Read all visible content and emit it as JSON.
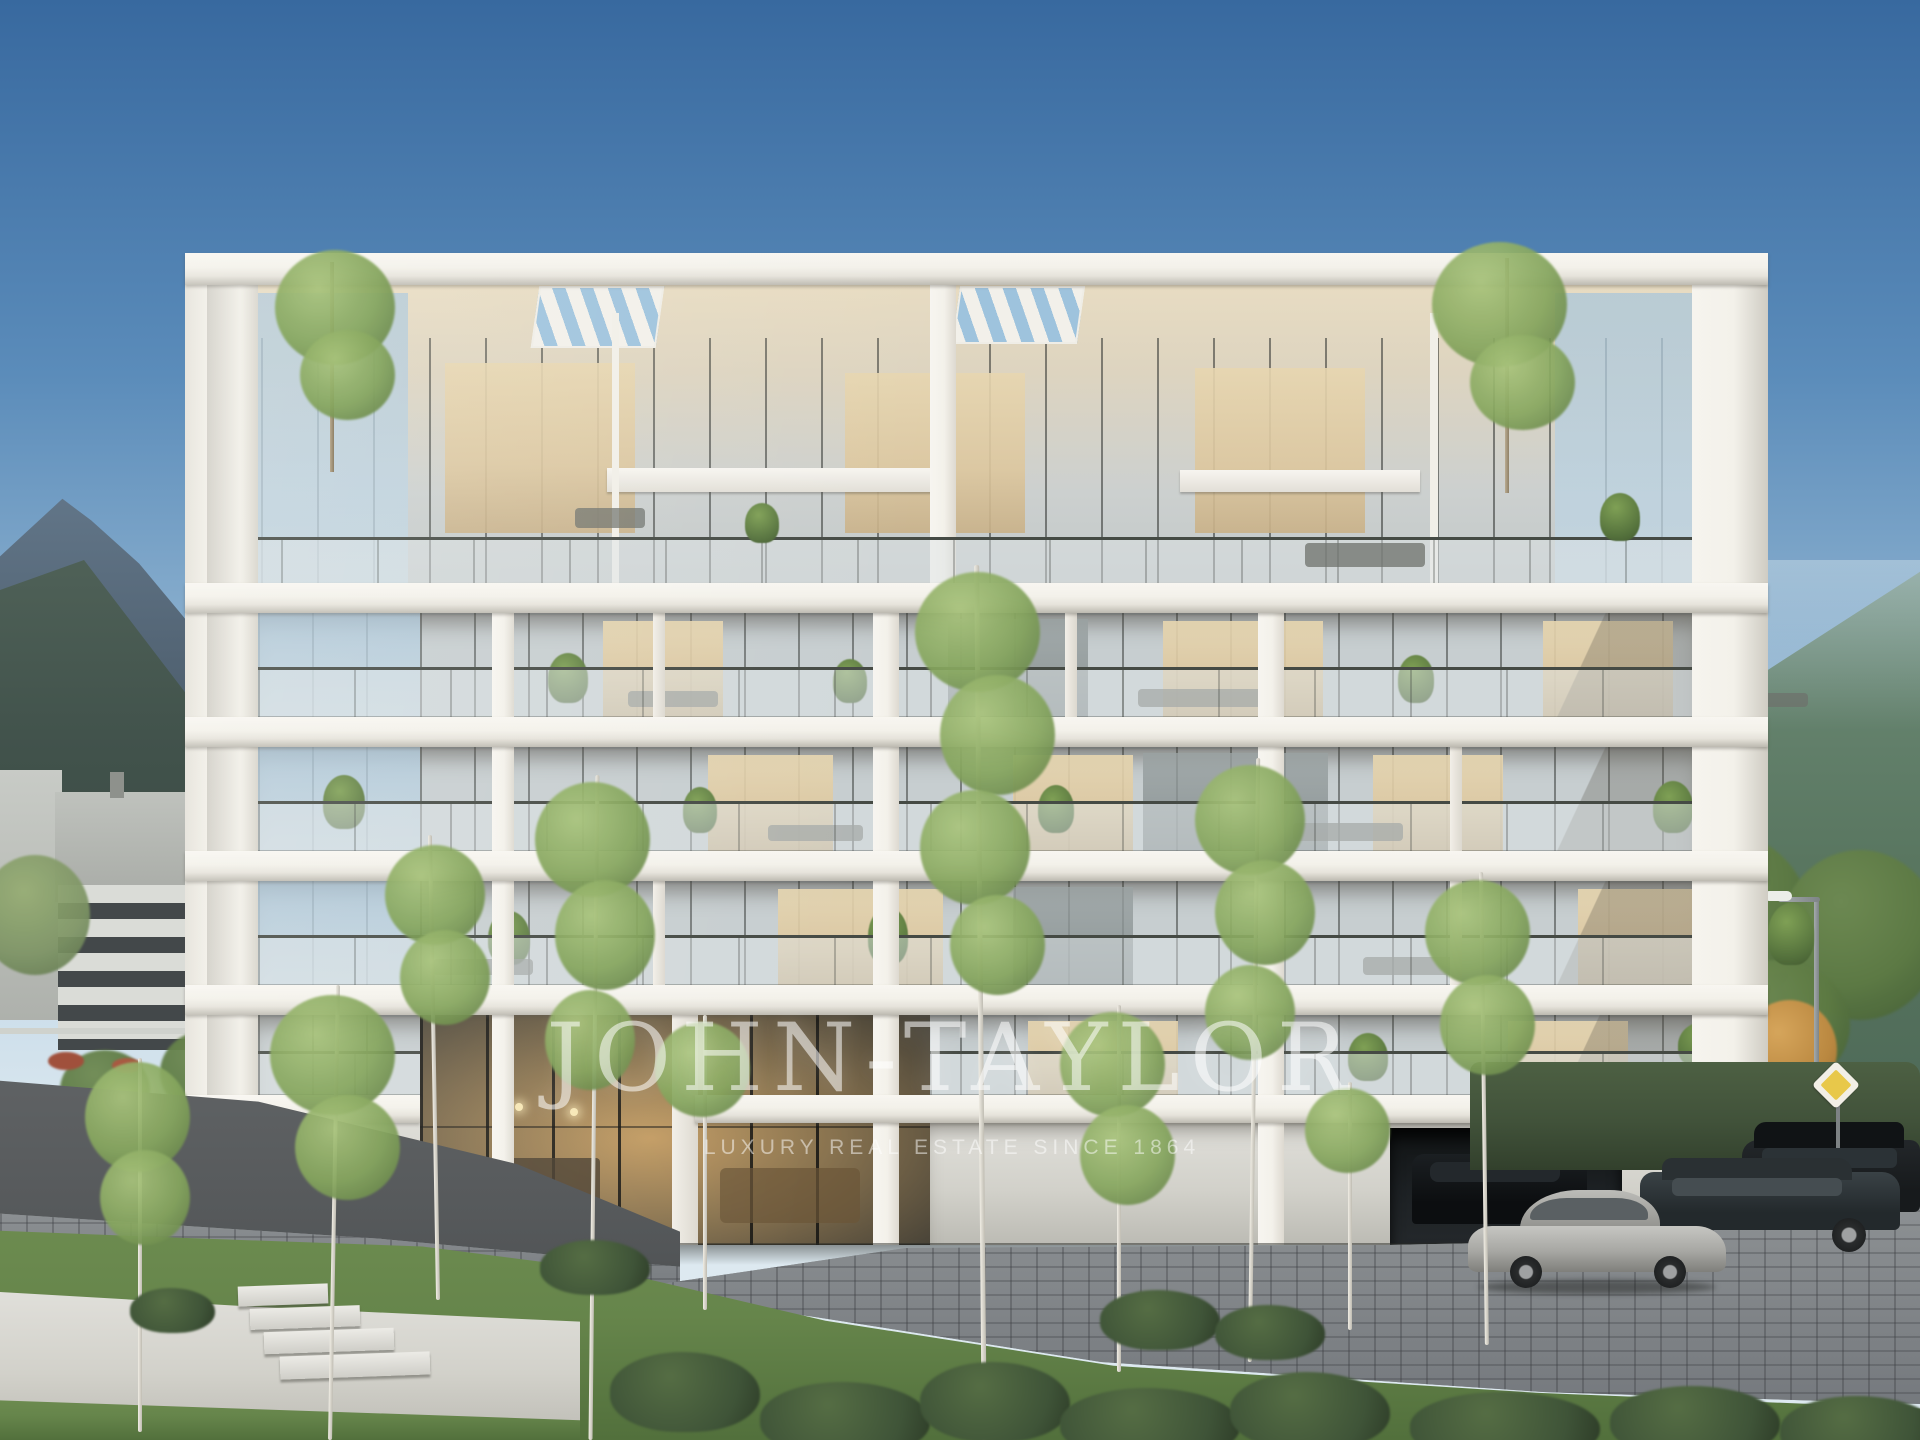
{
  "watermark": {
    "title": "JOHN-TAYLOR",
    "tagline": "LUXURY REAL ESTATE SINCE 1864"
  },
  "palette": {
    "sky_top": "#38699f",
    "sky_mid": "#5b8cba",
    "sky_low": "#93b6d2",
    "sky_horizon": "#c9dce9",
    "bld_white": "#f3f1ea",
    "slab_edge": "#bdbab1",
    "glass_cool": "#c7ced0",
    "glass_sky": "#aac6da",
    "glass_warm": "#ddc79e",
    "glass_warm2": "#e7d6b0",
    "mullion": "#3a3d3a",
    "rail": "#454a44",
    "balustrade": "rgba(222,228,230,0.5)",
    "mtn_rock": "#64788b",
    "mtn_rock_d": "#4d5e6d",
    "mtn_green": "#6f8d79",
    "mtn_green_d": "#597660",
    "leaf": "#86a65e",
    "leaf_l": "#a9c47c",
    "leaf_d": "#5d7a43",
    "bush": "#3f5438",
    "grass": "#66854b",
    "grass_d": "#52703c",
    "asphalt": "#56595b",
    "paver": "#8b8f90",
    "paver_d": "#71757a",
    "wall": "#d2d1ca",
    "hedge": "#41523a",
    "car_silver": "#a7a7a3",
    "car_dark": "#171a1c",
    "autumn": "#c08a41",
    "sign_yellow": "#e8c84a",
    "wm": "rgba(255,255,255,0.55)",
    "lobby_warm": "#c39c63",
    "lobby_dark": "#3c3a33"
  }
}
